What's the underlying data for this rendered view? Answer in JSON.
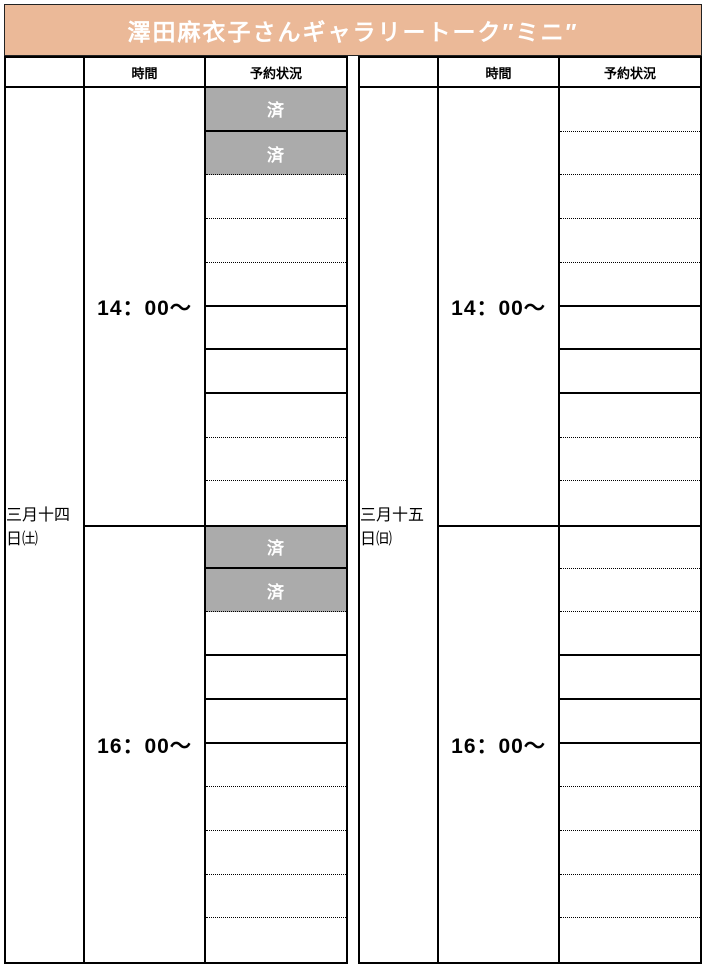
{
  "title": "澤田麻衣子さんギャラリートーク″ミニ″",
  "reserved_label": "済",
  "headers": {
    "time": "時間",
    "status": "予約状況"
  },
  "colors": {
    "title_bg": "#ebb998",
    "title_text": "#ffffff",
    "reserved_bg": "#ababab",
    "reserved_text": "#ffffff",
    "line": "#000000"
  },
  "tables": [
    {
      "date": "三月十四日㈯",
      "blocks": [
        {
          "time": "14：00～",
          "slots": [
            {
              "reserved": true,
              "divider": "solid"
            },
            {
              "reserved": true,
              "divider": "dotted"
            },
            {
              "reserved": false,
              "divider": "dotted"
            },
            {
              "reserved": false,
              "divider": "dotted"
            },
            {
              "reserved": false,
              "divider": "solid"
            },
            {
              "reserved": false,
              "divider": "solid"
            },
            {
              "reserved": false,
              "divider": "solid"
            },
            {
              "reserved": false,
              "divider": "dotted"
            },
            {
              "reserved": false,
              "divider": "dotted"
            },
            {
              "reserved": false,
              "divider": "none"
            }
          ]
        },
        {
          "time": "16：00～",
          "slots": [
            {
              "reserved": true,
              "divider": "solid"
            },
            {
              "reserved": true,
              "divider": "dotted"
            },
            {
              "reserved": false,
              "divider": "solid"
            },
            {
              "reserved": false,
              "divider": "solid"
            },
            {
              "reserved": false,
              "divider": "solid"
            },
            {
              "reserved": false,
              "divider": "dotted"
            },
            {
              "reserved": false,
              "divider": "dotted"
            },
            {
              "reserved": false,
              "divider": "dotted"
            },
            {
              "reserved": false,
              "divider": "dotted"
            },
            {
              "reserved": false,
              "divider": "none"
            }
          ]
        }
      ]
    },
    {
      "date": "三月十五日㈰",
      "blocks": [
        {
          "time": "14：00～",
          "slots": [
            {
              "reserved": false,
              "divider": "dotted"
            },
            {
              "reserved": false,
              "divider": "dotted"
            },
            {
              "reserved": false,
              "divider": "dotted"
            },
            {
              "reserved": false,
              "divider": "dotted"
            },
            {
              "reserved": false,
              "divider": "solid"
            },
            {
              "reserved": false,
              "divider": "solid"
            },
            {
              "reserved": false,
              "divider": "solid"
            },
            {
              "reserved": false,
              "divider": "dotted"
            },
            {
              "reserved": false,
              "divider": "dotted"
            },
            {
              "reserved": false,
              "divider": "none"
            }
          ]
        },
        {
          "time": "16：00～",
          "slots": [
            {
              "reserved": false,
              "divider": "dotted"
            },
            {
              "reserved": false,
              "divider": "dotted"
            },
            {
              "reserved": false,
              "divider": "solid"
            },
            {
              "reserved": false,
              "divider": "solid"
            },
            {
              "reserved": false,
              "divider": "solid"
            },
            {
              "reserved": false,
              "divider": "dotted"
            },
            {
              "reserved": false,
              "divider": "dotted"
            },
            {
              "reserved": false,
              "divider": "dotted"
            },
            {
              "reserved": false,
              "divider": "dotted"
            },
            {
              "reserved": false,
              "divider": "none"
            }
          ]
        }
      ]
    }
  ]
}
